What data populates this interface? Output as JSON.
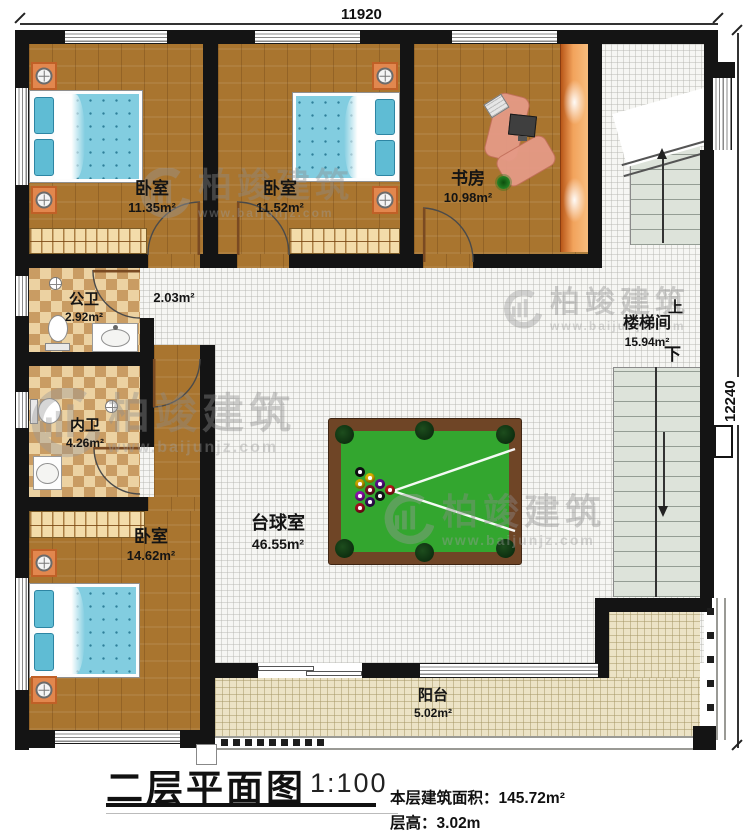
{
  "title": {
    "name": "二层平面图",
    "scale": "1:100",
    "area_label": "本层建筑面积：",
    "area_value": "145.72m²",
    "height_label": "层高：",
    "height_value": "3.02m"
  },
  "dimensions": {
    "top": "11920",
    "right": "12240"
  },
  "rooms": [
    {
      "name": "卧室",
      "area": "11.35m²"
    },
    {
      "name": "卧室",
      "area": "11.52m²"
    },
    {
      "name": "书房",
      "area": "10.98m²"
    },
    {
      "name": "公卫",
      "area": "2.92m²"
    },
    {
      "name": "",
      "area": "2.03m²"
    },
    {
      "name": "内卫",
      "area": "4.26m²"
    },
    {
      "name": "卧室",
      "area": "14.62m²"
    },
    {
      "name": "台球室",
      "area": "46.55m²"
    },
    {
      "name": "楼梯间",
      "area": "15.94m²",
      "up": "上",
      "down": "下"
    },
    {
      "name": "阳台",
      "area": "5.02m²"
    }
  ],
  "watermark": {
    "brand": "柏竣建筑",
    "url": "www.baijunjz.com"
  },
  "colors": {
    "wall": "#141414",
    "wood": "#a9752f",
    "tile": "#f6f6f3",
    "balcony": "#ece3c6",
    "felt": "#33a62f",
    "table_frame": "#6f4526",
    "nightstand": "#e2874e",
    "mattress": "#82cde0"
  }
}
